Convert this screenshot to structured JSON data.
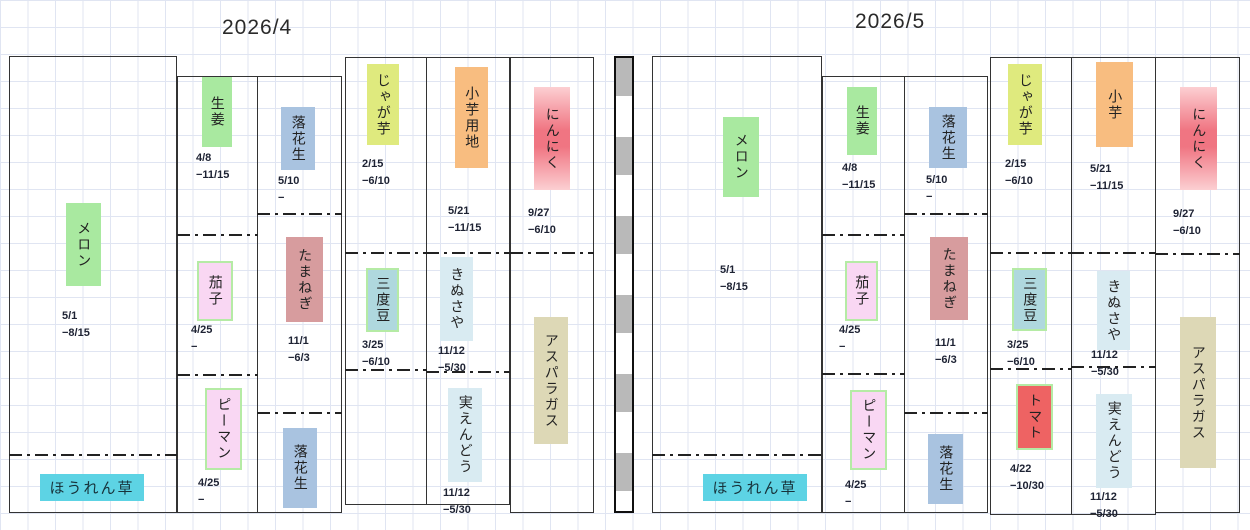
{
  "titles": {
    "left": "2026/4",
    "right": "2026/5"
  },
  "colors": {
    "grid_line": "#e0e5f2",
    "green": "#a9e9a0",
    "blue_gray": "#a9c3e0",
    "pale_pink": "#f9d7f3",
    "green_border": "#b5eba5",
    "dusty_rose": "#d79c9e",
    "yellow_green": "#dfea7e",
    "teal": "#afd8de",
    "orange": "#f8bd80",
    "light_cyan": "#d9ebf2",
    "garlic_pink": "#f07582",
    "tan": "#ddd8b6",
    "tomato_red": "#ee6363",
    "spinach_cyan": "#5dd3e4",
    "bar_gray": "#b9b9b9"
  },
  "panels": [
    {
      "month": "2026/4",
      "crops": {
        "melon": {
          "name": "メロン",
          "dates": "5/1\n−8/15"
        },
        "ginger": {
          "name": "生姜",
          "dates": "4/8\n−11/15"
        },
        "peanut_top": {
          "name": "落花生",
          "dates": "5/10\n−"
        },
        "eggplant": {
          "name": "茄子",
          "dates": "4/25\n−"
        },
        "onion": {
          "name": "たまねぎ",
          "dates": "11/1\n−6/3"
        },
        "green_pepper": {
          "name": "ピーマン",
          "dates": "4/25\n−"
        },
        "peanut_bottom": {
          "name": "落花生"
        },
        "spinach": {
          "name": "ほうれん草"
        },
        "potato": {
          "name": "じゃが芋",
          "dates": "2/15\n−6/10"
        },
        "string_beans": {
          "name": "三度豆",
          "dates": "3/25\n−6/10"
        },
        "taro": {
          "name": "小芋用地",
          "dates": "5/21\n−11/15"
        },
        "snow_peas": {
          "name": "きぬさや",
          "dates": "11/12\n−5/30"
        },
        "shelling_peas": {
          "name": "実えんどう",
          "dates": "11/12\n−5/30"
        },
        "garlic": {
          "name": "にんにく",
          "dates": "9/27\n−6/10"
        },
        "asparagus": {
          "name": "アスパラガス"
        }
      }
    },
    {
      "month": "2026/5",
      "crops": {
        "melon": {
          "name": "メロン",
          "dates": "5/1\n−8/15"
        },
        "ginger": {
          "name": "生姜",
          "dates": "4/8\n−11/15"
        },
        "peanut_top": {
          "name": "落花生",
          "dates": "5/10\n−"
        },
        "eggplant": {
          "name": "茄子",
          "dates": "4/25\n−"
        },
        "onion": {
          "name": "たまねぎ",
          "dates": "11/1\n−6/3"
        },
        "green_pepper": {
          "name": "ピーマン",
          "dates": "4/25\n−"
        },
        "peanut_bottom": {
          "name": "落花生"
        },
        "spinach": {
          "name": "ほうれん草"
        },
        "potato": {
          "name": "じゃが芋",
          "dates": "2/15\n−6/10"
        },
        "string_beans": {
          "name": "三度豆",
          "dates": "3/25\n−6/10"
        },
        "tomato": {
          "name": "トマト",
          "dates": "4/22\n−10/30"
        },
        "taro": {
          "name": "小芋",
          "dates": "5/21\n−11/15"
        },
        "snow_peas": {
          "name": "きぬさや",
          "dates": "11/12\n−5/30"
        },
        "shelling_peas": {
          "name": "実えんどう",
          "dates": "11/12\n−5/30"
        },
        "garlic": {
          "name": "にんにく",
          "dates": "9/27\n−6/10"
        },
        "asparagus": {
          "name": "アスパラガス"
        }
      }
    }
  ]
}
